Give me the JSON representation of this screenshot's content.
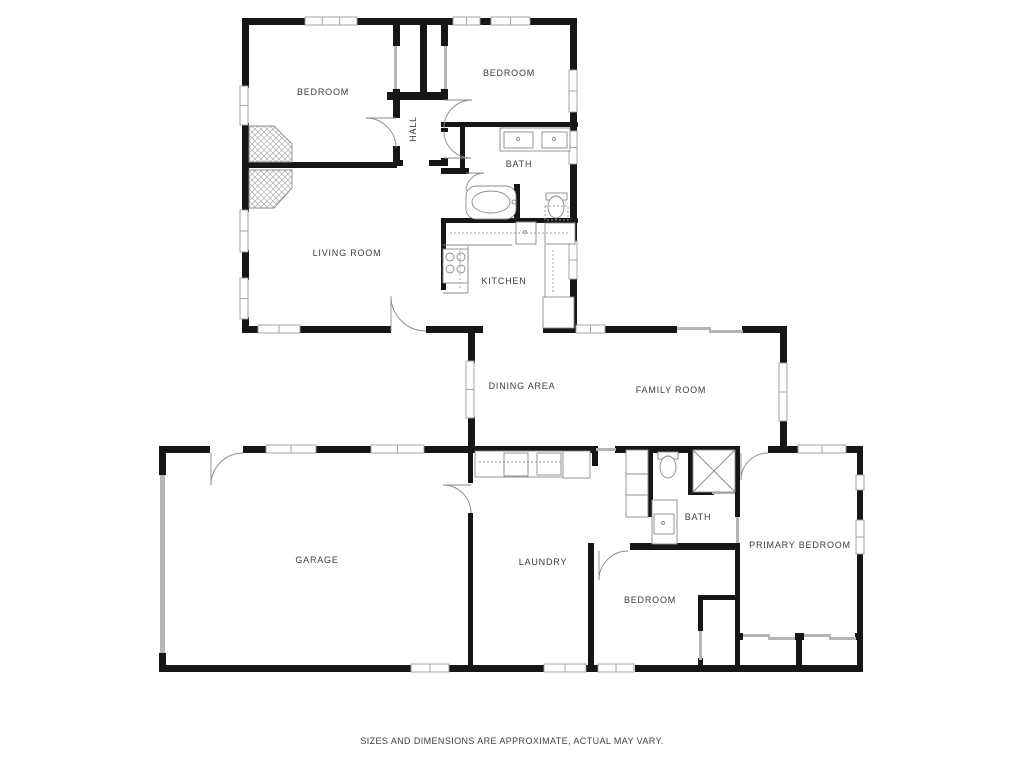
{
  "disclaimer": "SIZES AND DIMENSIONS ARE APPROXIMATE, ACTUAL MAY VARY.",
  "colors": {
    "background": "#ffffff",
    "wall": "#161616",
    "thin": "#8a8a8a",
    "light": "#b5b5b5",
    "window_border": "#9b9b9b",
    "label": "#3c3c3c",
    "hatch": "#adadad"
  },
  "canvas": {
    "w": 1024,
    "h": 768
  },
  "labels": [
    {
      "id": "bedroom-front-left",
      "t": "BEDROOM",
      "x": 323,
      "y": 95,
      "r": 0
    },
    {
      "id": "bedroom-front-right",
      "t": "BEDROOM",
      "x": 509,
      "y": 76,
      "r": 0
    },
    {
      "id": "hall",
      "t": "HALL",
      "x": 416,
      "y": 129,
      "r": -90
    },
    {
      "id": "bath-main",
      "t": "BATH",
      "x": 519,
      "y": 167,
      "r": 0
    },
    {
      "id": "living-room",
      "t": "LIVING ROOM",
      "x": 347,
      "y": 256,
      "r": 0
    },
    {
      "id": "kitchen",
      "t": "KITCHEN",
      "x": 504,
      "y": 284,
      "r": 0
    },
    {
      "id": "dining-area",
      "t": "DINING AREA",
      "x": 522,
      "y": 389,
      "r": 0
    },
    {
      "id": "family-room",
      "t": "FAMILY ROOM",
      "x": 671,
      "y": 393,
      "r": 0
    },
    {
      "id": "garage",
      "t": "GARAGE",
      "x": 317,
      "y": 563,
      "r": 0
    },
    {
      "id": "laundry",
      "t": "LAUNDRY",
      "x": 543,
      "y": 565,
      "r": 0
    },
    {
      "id": "bath-second",
      "t": "BATH",
      "x": 698,
      "y": 520,
      "r": 0
    },
    {
      "id": "bedroom-third",
      "t": "BEDROOM",
      "x": 650,
      "y": 603,
      "r": 0
    },
    {
      "id": "primary-bedroom",
      "t": "PRIMARY BEDROOM",
      "x": 800,
      "y": 548,
      "r": 0
    }
  ],
  "walls": [
    [
      242,
      18,
      65,
      7
    ],
    [
      355,
      18,
      100,
      7
    ],
    [
      478,
      18,
      15,
      7
    ],
    [
      526,
      18,
      51,
      7
    ],
    [
      570,
      18,
      7,
      54
    ],
    [
      570,
      110,
      7,
      23
    ],
    [
      570,
      162,
      7,
      81
    ],
    [
      570,
      277,
      7,
      56
    ],
    [
      242,
      18,
      7,
      70
    ],
    [
      242,
      123,
      7,
      89
    ],
    [
      242,
      250,
      7,
      30
    ],
    [
      242,
      317,
      7,
      16
    ],
    [
      242,
      162,
      155,
      6
    ],
    [
      242,
      326,
      18,
      7
    ],
    [
      298,
      326,
      93,
      7
    ],
    [
      426,
      326,
      57,
      7
    ],
    [
      543,
      326,
      35,
      7
    ],
    [
      603,
      326,
      74,
      7
    ],
    [
      742,
      326,
      45,
      7
    ],
    [
      393,
      19,
      7,
      27
    ],
    [
      393,
      89,
      7,
      29
    ],
    [
      393,
      146,
      7,
      20
    ],
    [
      441,
      19,
      7,
      27
    ],
    [
      441,
      89,
      7,
      11
    ],
    [
      441,
      128,
      7,
      4
    ],
    [
      441,
      158,
      7,
      8
    ],
    [
      420,
      19,
      7,
      73
    ],
    [
      387,
      92,
      61,
      8
    ],
    [
      393,
      160,
      10,
      6
    ],
    [
      429,
      160,
      12,
      6
    ],
    [
      441,
      122,
      137,
      5
    ],
    [
      460,
      127,
      5,
      45
    ],
    [
      441,
      168,
      28,
      6
    ],
    [
      514,
      184,
      6,
      39
    ],
    [
      441,
      218,
      137,
      5
    ],
    [
      441,
      223,
      5,
      67
    ],
    [
      780,
      326,
      7,
      39
    ],
    [
      780,
      420,
      7,
      33
    ],
    [
      468,
      333,
      7,
      30
    ],
    [
      468,
      417,
      7,
      36
    ],
    [
      162,
      446,
      48,
      7
    ],
    [
      243,
      446,
      24,
      7
    ],
    [
      316,
      446,
      56,
      7
    ],
    [
      423,
      446,
      169,
      7
    ],
    [
      592,
      446,
      6,
      20
    ],
    [
      615,
      446,
      33,
      7
    ],
    [
      648,
      446,
      92,
      7
    ],
    [
      768,
      446,
      32,
      7
    ],
    [
      845,
      446,
      18,
      7
    ],
    [
      159,
      446,
      7,
      29
    ],
    [
      159,
      653,
      7,
      19
    ],
    [
      468,
      453,
      5,
      30
    ],
    [
      468,
      513,
      5,
      159
    ],
    [
      159,
      665,
      254,
      7
    ],
    [
      449,
      665,
      97,
      7
    ],
    [
      586,
      665,
      14,
      7
    ],
    [
      635,
      665,
      228,
      7
    ],
    [
      588,
      543,
      6,
      129
    ],
    [
      648,
      453,
      5,
      64
    ],
    [
      630,
      543,
      110,
      7
    ],
    [
      688,
      453,
      5,
      42
    ],
    [
      688,
      490,
      26,
      5
    ],
    [
      735,
      453,
      5,
      64
    ],
    [
      735,
      543,
      5,
      124
    ],
    [
      698,
      595,
      40,
      5
    ],
    [
      698,
      600,
      5,
      31
    ],
    [
      698,
      658,
      5,
      9
    ],
    [
      735,
      633,
      8,
      7
    ],
    [
      795,
      633,
      9,
      7
    ],
    [
      855,
      633,
      8,
      7
    ],
    [
      796,
      640,
      6,
      27
    ],
    [
      857,
      446,
      6,
      31
    ],
    [
      857,
      488,
      6,
      32
    ],
    [
      857,
      553,
      6,
      119
    ]
  ],
  "windows": [
    [
      305,
      17,
      52,
      8,
      2
    ],
    [
      453,
      17,
      27,
      8,
      1
    ],
    [
      491,
      17,
      39,
      8,
      1
    ],
    [
      240,
      86,
      8,
      39,
      1
    ],
    [
      240,
      210,
      8,
      42,
      1
    ],
    [
      240,
      278,
      8,
      41,
      1
    ],
    [
      258,
      325,
      42,
      8,
      1
    ],
    [
      569,
      70,
      8,
      42,
      1
    ],
    [
      569,
      131,
      8,
      33,
      1
    ],
    [
      569,
      241,
      8,
      38,
      1
    ],
    [
      576,
      325,
      29,
      8,
      1
    ],
    [
      466,
      361,
      8,
      57,
      1
    ],
    [
      779,
      363,
      8,
      58,
      1
    ],
    [
      266,
      445,
      50,
      8,
      1
    ],
    [
      371,
      445,
      53,
      8,
      1
    ],
    [
      798,
      445,
      48,
      8,
      1
    ],
    [
      856,
      475,
      8,
      15,
      0
    ],
    [
      856,
      520,
      8,
      34,
      1
    ],
    [
      411,
      664,
      38,
      8,
      1
    ],
    [
      544,
      664,
      42,
      8,
      1
    ],
    [
      598,
      664,
      36,
      8,
      1
    ]
  ],
  "light_rects": [
    [
      677,
      327,
      34,
      3
    ],
    [
      709,
      330,
      34,
      3
    ],
    [
      743,
      634,
      27,
      3
    ],
    [
      768,
      637,
      27,
      3
    ],
    [
      804,
      634,
      27,
      3
    ],
    [
      829,
      637,
      27,
      3
    ],
    [
      699,
      631,
      3,
      29
    ],
    [
      596,
      448,
      20,
      3
    ],
    [
      394,
      46,
      3,
      43
    ],
    [
      444,
      46,
      3,
      43
    ],
    [
      160,
      475,
      5,
      178
    ],
    [
      712,
      491,
      23,
      3
    ],
    [
      736,
      517,
      3,
      26
    ]
  ],
  "doors": [
    {
      "name": "bedroom-front-left-door",
      "cx": 396,
      "cy": 118,
      "r": 30,
      "leaf": 180,
      "wall": 90
    },
    {
      "name": "bedroom-front-right-door",
      "cx": 444,
      "cy": 100,
      "r": 28,
      "leaf": 0,
      "wall": 90
    },
    {
      "name": "bath-main-door",
      "cx": 444,
      "cy": 158,
      "r": 27,
      "leaf": 0,
      "wall": -90
    },
    {
      "name": "tub-compartment-door",
      "cx": 466,
      "cy": 173,
      "r": 18,
      "leaf": 0,
      "wall": 90
    },
    {
      "name": "living-room-exterior-door",
      "cx": 391,
      "cy": 331,
      "r": 35,
      "leaf": 270,
      "wall": 360
    },
    {
      "name": "garage-entry-door",
      "cx": 211,
      "cy": 453,
      "r": 32,
      "leaf": 90,
      "wall": 0
    },
    {
      "name": "garage-laundry-door",
      "cx": 471,
      "cy": 485,
      "r": 28,
      "leaf": 180,
      "wall": 90
    },
    {
      "name": "bedroom-third-door",
      "cx": 599,
      "cy": 551,
      "r": 29,
      "leaf": 90,
      "wall": 0
    },
    {
      "name": "primary-bedroom-door",
      "cx": 741,
      "cy": 453,
      "r": 27,
      "leaf": 90,
      "wall": 0
    }
  ],
  "fixtures": {
    "boxes": [
      [
        500,
        128,
        70,
        23
      ],
      [
        504,
        132,
        29,
        16
      ],
      [
        542,
        132,
        25,
        16
      ],
      [
        546,
        193,
        21,
        7
      ],
      [
        516,
        222,
        20,
        22
      ],
      [
        443,
        249,
        25,
        34
      ],
      [
        543,
        297,
        31,
        31
      ],
      [
        545,
        223,
        30,
        21
      ],
      [
        475,
        451,
        88,
        26
      ],
      [
        504,
        453,
        24,
        23
      ],
      [
        537,
        453,
        24,
        22
      ],
      [
        563,
        451,
        27,
        27
      ],
      [
        626,
        450,
        22,
        24
      ],
      [
        626,
        474,
        22,
        21
      ],
      [
        626,
        495,
        22,
        22
      ],
      [
        658,
        452,
        20,
        7
      ],
      [
        652,
        500,
        25,
        44
      ],
      [
        654,
        514,
        20,
        20
      ]
    ],
    "round_boxes": [
      [
        466,
        186,
        50,
        33,
        10
      ]
    ],
    "ellipses": [
      [
        556,
        207,
        8,
        11
      ],
      [
        668,
        467,
        8,
        11
      ],
      [
        491,
        202,
        19,
        11
      ]
    ],
    "circles": [
      [
        450,
        257,
        4
      ],
      [
        461,
        257,
        4
      ],
      [
        450,
        269,
        4
      ],
      [
        461,
        269,
        4
      ],
      [
        518,
        139,
        1.5
      ],
      [
        554,
        139,
        1.5
      ],
      [
        525,
        232,
        1.5
      ],
      [
        663,
        523,
        1.5
      ],
      [
        514,
        202,
        2
      ],
      [
        696,
        470,
        2
      ]
    ],
    "lines": [
      [
        443,
        245,
        512,
        245
      ],
      [
        468,
        245,
        468,
        293
      ],
      [
        443,
        293,
        468,
        293
      ],
      [
        545,
        245,
        545,
        297
      ]
    ],
    "dashed_lines": [
      [
        450,
        233,
        568,
        233
      ],
      [
        460,
        250,
        460,
        288
      ],
      [
        553,
        250,
        553,
        293
      ],
      [
        479,
        462,
        561,
        462
      ]
    ],
    "dashed_rects": [
      [
        545,
        206,
        23,
        14
      ]
    ],
    "cross_boxes": [
      [
        693,
        450,
        42,
        42
      ]
    ],
    "hatch_polys": [
      [
        [
          249,
          126
        ],
        [
          274,
          126
        ],
        [
          292,
          144
        ],
        [
          292,
          162
        ],
        [
          249,
          162
        ]
      ],
      [
        [
          249,
          170
        ],
        [
          292,
          170
        ],
        [
          292,
          188
        ],
        [
          274,
          208
        ],
        [
          249,
          208
        ]
      ]
    ]
  }
}
